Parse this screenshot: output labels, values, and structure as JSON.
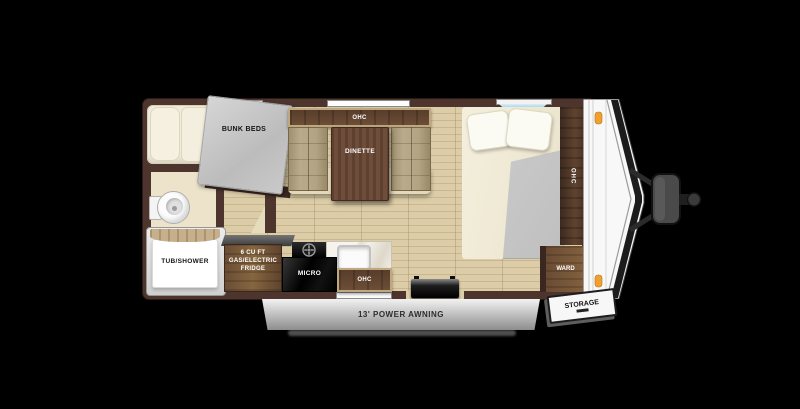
{
  "floorplan": {
    "type": "travel-trailer-floorplan",
    "labels": {
      "bunk_beds": "BUNK BEDS",
      "dinette_ohc": "OHC",
      "dinette": "DINETTE",
      "tub_shower": "TUB/SHOWER",
      "fridge": "6 CU FT\nGAS/ELECTRIC\nFRIDGE",
      "micro": "MICRO",
      "kitchen_ohc": "OHC",
      "bed_ohc": "OHC",
      "ward": "WARD",
      "storage": "STORAGE",
      "awning": "13' POWER AWNING"
    },
    "colors": {
      "background": "#000000",
      "wall_brown": "#4d342c",
      "floor_tan": "#d5c6a0",
      "cabinet_wood": "#6a4c34",
      "mattress_gray": "#c6c6c6",
      "bedding_cream": "#f1ecdb",
      "marker_light_orange": "#f0a030",
      "front_window_blue": "#63a9cf",
      "awning_gray": "#bdbdbd"
    }
  }
}
